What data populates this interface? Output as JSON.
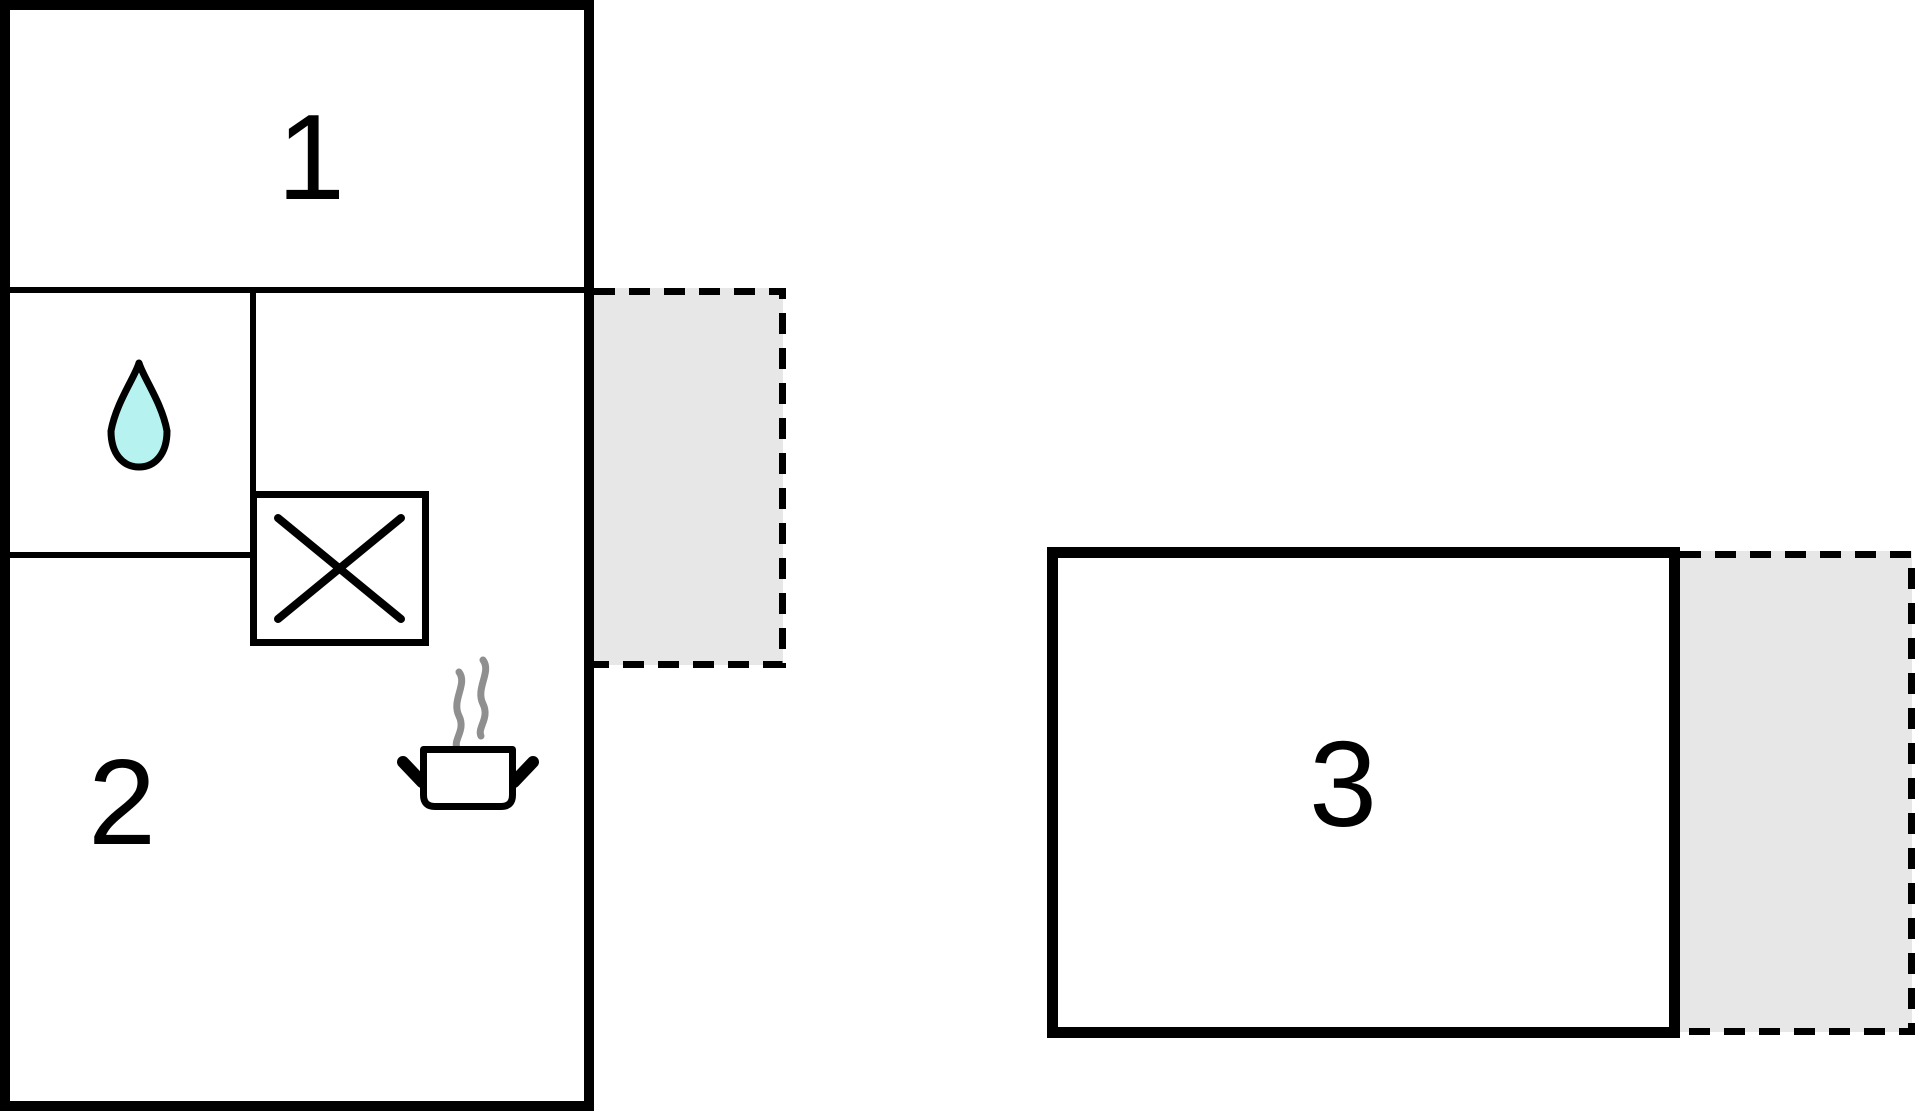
{
  "rooms": [
    {
      "label": "1"
    },
    {
      "label": "2"
    },
    {
      "label": "3"
    }
  ],
  "icons": {
    "water_drop": "water-drop-icon",
    "shower": "shower-x-icon",
    "pot": "steaming-pot-icon"
  },
  "colors": {
    "wall": "#000000",
    "room_fill": "#ffffff",
    "terrace_fill": "#e7e7e7",
    "terrace_border": "#000000",
    "drop_fill": "#b5f2f0",
    "drop_stroke": "#000000",
    "steam": "#8f8f8f",
    "pot_stroke": "#000000"
  }
}
